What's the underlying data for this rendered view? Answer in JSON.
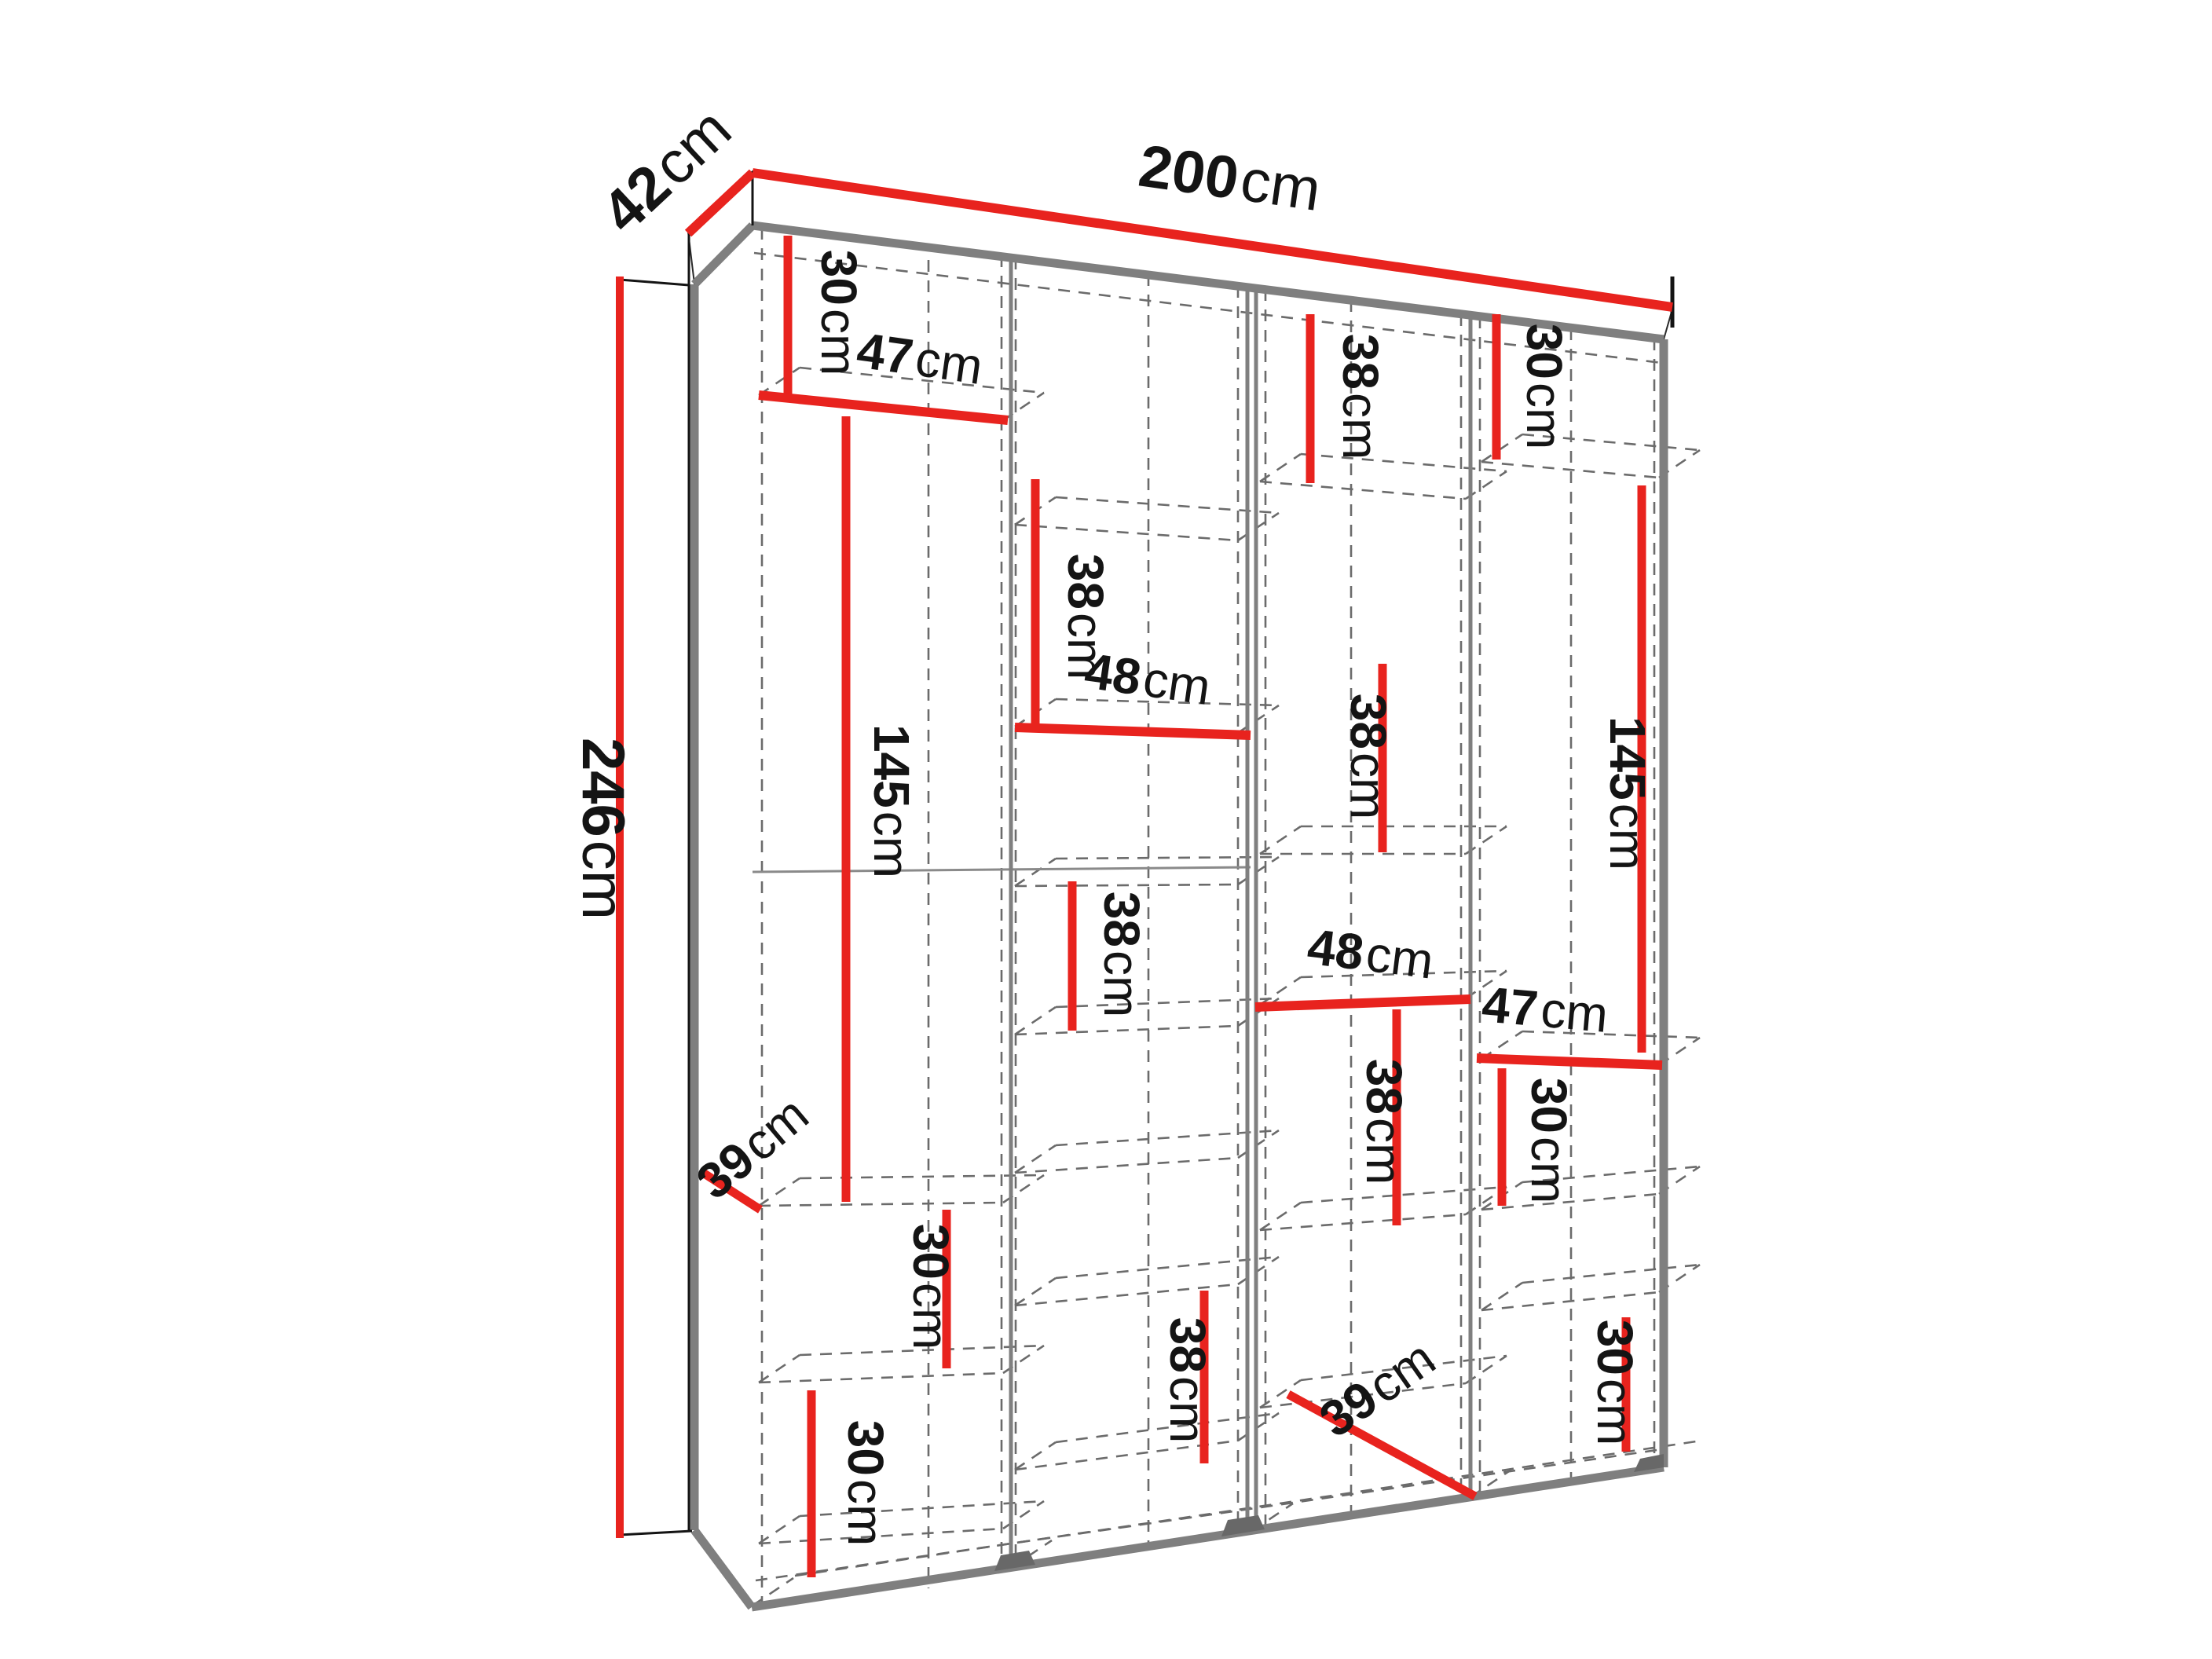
{
  "diagram": {
    "type": "furniture-dimension-drawing",
    "subject": "wardrobe interior shelf layout, perspective view",
    "unit": "cm",
    "overall": {
      "width": "200cm",
      "depth": "42cm",
      "height": "246cm"
    },
    "colors": {
      "dimension_line": "#e8231e",
      "structure_edge": "#7f7f7f",
      "hidden_edge": "#6b6b6b",
      "outline": "#141414",
      "foot": "#686868",
      "background": "#ffffff",
      "label_text": "#141414"
    }
  },
  "dims": {
    "d200": {
      "value": "200",
      "unit": "cm",
      "label": "overall-width"
    },
    "d42": {
      "value": "42",
      "unit": "cm",
      "label": "overall-depth"
    },
    "d246": {
      "value": "246",
      "unit": "cm",
      "label": "overall-height"
    },
    "c1_30t": {
      "value": "30",
      "unit": "cm",
      "label": "column1-top-compartment-height"
    },
    "c1_47": {
      "value": "47",
      "unit": "cm",
      "label": "column1-shelf-width"
    },
    "c1_145": {
      "value": "145",
      "unit": "cm",
      "label": "column1-hanging-space-height"
    },
    "c1_39": {
      "value": "39",
      "unit": "cm",
      "label": "column1-shelf-depth"
    },
    "c1_30a": {
      "value": "30",
      "unit": "cm",
      "label": "column1-lower-compartment-height-1"
    },
    "c1_30b": {
      "value": "30",
      "unit": "cm",
      "label": "column1-lower-compartment-height-2"
    },
    "c2_38a": {
      "value": "38",
      "unit": "cm",
      "label": "column2-upper-compartment-height"
    },
    "c2_48": {
      "value": "48",
      "unit": "cm",
      "label": "column2-shelf-width"
    },
    "c2_38b": {
      "value": "38",
      "unit": "cm",
      "label": "column2-middle-compartment-height"
    },
    "c2_38c": {
      "value": "38",
      "unit": "cm",
      "label": "column2-bottom-compartment-height"
    },
    "c3_38t": {
      "value": "38",
      "unit": "cm",
      "label": "column3-top-compartment-height"
    },
    "c3_38mu": {
      "value": "38",
      "unit": "cm",
      "label": "column3-upper-middle-compartment-height"
    },
    "c3_48": {
      "value": "48",
      "unit": "cm",
      "label": "column3-shelf-width"
    },
    "c3_38ml": {
      "value": "38",
      "unit": "cm",
      "label": "column3-lower-middle-compartment-height"
    },
    "c3_39": {
      "value": "39",
      "unit": "cm",
      "label": "column3-shelf-depth"
    },
    "c4_30t": {
      "value": "30",
      "unit": "cm",
      "label": "column4-top-compartment-height"
    },
    "c4_145": {
      "value": "145",
      "unit": "cm",
      "label": "column4-hanging-space-height"
    },
    "c4_47": {
      "value": "47",
      "unit": "cm",
      "label": "column4-shelf-width"
    },
    "c4_30a": {
      "value": "30",
      "unit": "cm",
      "label": "column4-lower-compartment-height-1"
    },
    "c4_30b": {
      "value": "30",
      "unit": "cm",
      "label": "column4-lower-compartment-height-2"
    }
  }
}
